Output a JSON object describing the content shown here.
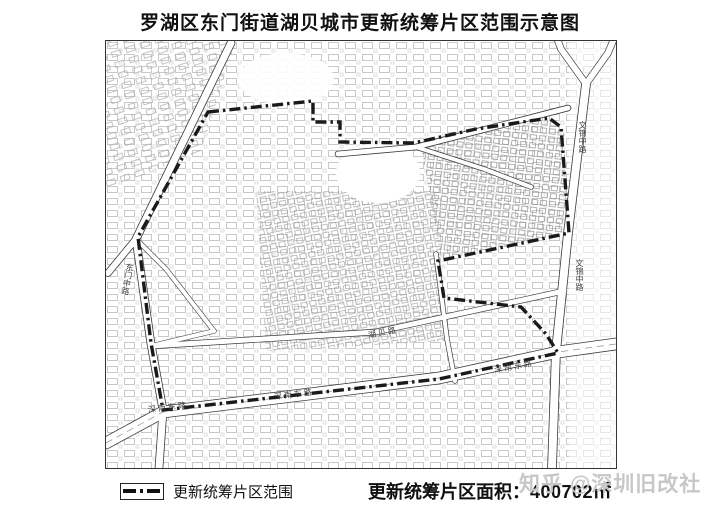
{
  "header": {
    "title": "罗湖区东门街道湖贝城市更新统筹片区范围示意图"
  },
  "map": {
    "boundary_color": "#1a1a1a",
    "road_labels": [
      {
        "id": "dongmen-mid-road",
        "text": "东门中路"
      },
      {
        "id": "wenjin-mid-road-north",
        "text": "文锦中路"
      },
      {
        "id": "wenjin-mid-road-south",
        "text": "文锦中路"
      },
      {
        "id": "shennan-east-road-west",
        "text": "深南东路"
      },
      {
        "id": "shennan-east-road-mid",
        "text": "深南东路"
      },
      {
        "id": "shennan-east-road-east",
        "text": "深南东路"
      },
      {
        "id": "hubei-road",
        "text": "湖贝路"
      }
    ]
  },
  "legend": {
    "symbol": "dash-dot-line",
    "label": "更新统筹片区范围"
  },
  "footer": {
    "area_label": "更新统筹片区面积：",
    "area_value": "400702",
    "area_unit": "㎡"
  },
  "watermark": {
    "text": "知乎 @深圳旧改社"
  }
}
